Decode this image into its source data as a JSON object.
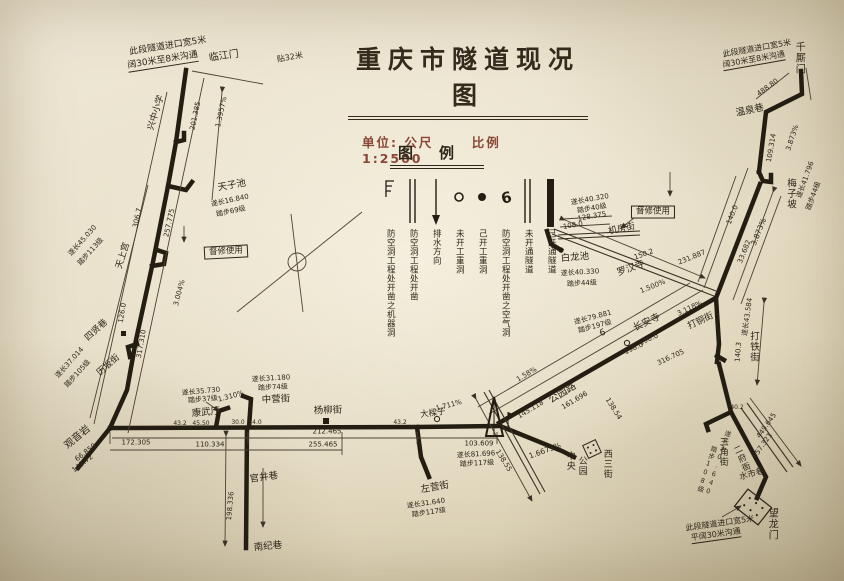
{
  "title": "重庆市隧道现况图",
  "subtitle": {
    "unit_label": "单位: 公尺",
    "scale_label": "比例 1:2500"
  },
  "colors": {
    "ink": "#2e2619",
    "thin_line": "#4c4234",
    "accent_red": "#8a4636",
    "paper": "#e9e1cb"
  },
  "legend": {
    "title": "图例",
    "entries": [
      {
        "symbol": "bracket-icon",
        "label": "防空洞工程处开凿之机器洞"
      },
      {
        "symbol": "double-line-icon",
        "label": "防空洞工程处开凿"
      },
      {
        "symbol": "arrow-down-icon",
        "label": "排水方向"
      },
      {
        "symbol": "open-circle-icon",
        "label": "未开工重洞"
      },
      {
        "symbol": "solid-dot-icon",
        "label": "己开工重洞"
      },
      {
        "symbol": "air-hole-icon",
        "label": "防空洞工程处开凿之空气洞"
      },
      {
        "symbol": "double-line-icon",
        "label": "未开通隧道"
      },
      {
        "symbol": "thick-bar-icon",
        "label": "己开通隧道"
      }
    ]
  },
  "map": {
    "labels": [
      {
        "t": "此段隧道进口宽5米",
        "x": 168,
        "y": 47,
        "r": -9,
        "s": 9
      },
      {
        "t": "阔30米至8米沟通",
        "x": 163,
        "y": 62,
        "r": -9,
        "s": 9,
        "u": 1
      },
      {
        "t": "贴32米",
        "x": 290,
        "y": 58,
        "r": -10,
        "s": 8
      },
      {
        "t": "临江门",
        "x": 224,
        "y": 57,
        "r": -8,
        "s": 10
      },
      {
        "t": "兴中小学",
        "x": 157,
        "y": 113,
        "r": -73,
        "s": 9
      },
      {
        "t": "1.3957%",
        "x": 222,
        "y": 112,
        "r": -78,
        "s": 7
      },
      {
        "t": "201.385",
        "x": 196,
        "y": 116,
        "r": -78,
        "s": 7
      },
      {
        "t": "天子池",
        "x": 232,
        "y": 186,
        "r": -10,
        "s": 9.5
      },
      {
        "t": "遂长16.840",
        "x": 230,
        "y": 201,
        "r": -12,
        "s": 7
      },
      {
        "t": "踏步69级",
        "x": 231,
        "y": 212,
        "r": -12,
        "s": 7
      },
      {
        "t": "督修使用",
        "x": 226,
        "y": 252,
        "r": -3,
        "s": 8.5,
        "b": 1
      },
      {
        "t": "306.7",
        "x": 138,
        "y": 218,
        "r": -78,
        "s": 7
      },
      {
        "t": "257.775",
        "x": 170,
        "y": 223,
        "r": -78,
        "s": 7
      },
      {
        "t": "天上宫",
        "x": 124,
        "y": 256,
        "r": -73,
        "s": 9
      },
      {
        "t": "遂长45.030",
        "x": 83,
        "y": 241,
        "r": -48,
        "s": 7
      },
      {
        "t": "踏步113级",
        "x": 91,
        "y": 252,
        "r": -48,
        "s": 7
      },
      {
        "t": "3.004%",
        "x": 180,
        "y": 293,
        "r": -75,
        "s": 7
      },
      {
        "t": "126.0",
        "x": 123,
        "y": 313,
        "r": -80,
        "s": 7
      },
      {
        "t": "317.310",
        "x": 142,
        "y": 344,
        "r": -80,
        "s": 7
      },
      {
        "t": "四贤巷",
        "x": 97,
        "y": 331,
        "r": -42,
        "s": 9
      },
      {
        "t": "历坂街",
        "x": 109,
        "y": 366,
        "r": -42,
        "s": 9
      },
      {
        "t": "遂长37.014",
        "x": 70,
        "y": 363,
        "r": -48,
        "s": 7
      },
      {
        "t": "踏步105级",
        "x": 78,
        "y": 374,
        "r": -48,
        "s": 7
      },
      {
        "t": "观音岩",
        "x": 78,
        "y": 438,
        "r": -40,
        "s": 10
      },
      {
        "t": "66.850",
        "x": 86,
        "y": 453,
        "r": -38,
        "s": 7
      },
      {
        "t": "149.72",
        "x": 83,
        "y": 464,
        "r": -38,
        "s": 7
      },
      {
        "t": "172.305",
        "x": 136,
        "y": 443,
        "r": 0,
        "s": 7
      },
      {
        "t": "110.334",
        "x": 210,
        "y": 445,
        "r": 0,
        "s": 7
      },
      {
        "t": "43.2",
        "x": 180,
        "y": 424,
        "r": 0,
        "s": 6
      },
      {
        "t": "45.50",
        "x": 201,
        "y": 424,
        "r": 0,
        "s": 6
      },
      {
        "t": "康武厅",
        "x": 206,
        "y": 413,
        "r": -5,
        "s": 9.5
      },
      {
        "t": "遂长35.730",
        "x": 201,
        "y": 392,
        "r": -5,
        "s": 7
      },
      {
        "t": "踏步37级",
        "x": 203,
        "y": 400,
        "r": -5,
        "s": 7
      },
      {
        "t": "1.310%",
        "x": 231,
        "y": 397,
        "r": -15,
        "s": 7
      },
      {
        "t": "中营街",
        "x": 276,
        "y": 400,
        "r": -3,
        "s": 9.5
      },
      {
        "t": "遂长31.180",
        "x": 271,
        "y": 379,
        "r": -3,
        "s": 7
      },
      {
        "t": "踏步74级",
        "x": 273,
        "y": 388,
        "r": -3,
        "s": 7
      },
      {
        "t": "30.0",
        "x": 238,
        "y": 423,
        "r": 0,
        "s": 6
      },
      {
        "t": "14.0",
        "x": 255,
        "y": 423,
        "r": 0,
        "s": 6
      },
      {
        "t": "杨柳街",
        "x": 328,
        "y": 411,
        "r": -2,
        "s": 9.5
      },
      {
        "t": "212.465",
        "x": 327,
        "y": 432,
        "r": 0,
        "s": 7
      },
      {
        "t": "255.465",
        "x": 323,
        "y": 445,
        "r": 0,
        "s": 7
      },
      {
        "t": "43.2",
        "x": 400,
        "y": 423,
        "r": 0,
        "s": 6
      },
      {
        "t": "官井巷",
        "x": 264,
        "y": 478,
        "r": -8,
        "s": 9.5
      },
      {
        "t": "198.336",
        "x": 231,
        "y": 506,
        "r": -85,
        "s": 7
      },
      {
        "t": "南纪巷",
        "x": 268,
        "y": 547,
        "r": -5,
        "s": 9.5
      },
      {
        "t": "大樑子",
        "x": 433,
        "y": 414,
        "r": -8,
        "s": 8.5
      },
      {
        "t": "103.609",
        "x": 479,
        "y": 444,
        "r": 0,
        "s": 7
      },
      {
        "t": "遂长81.696",
        "x": 476,
        "y": 455,
        "r": -3,
        "s": 7
      },
      {
        "t": "踏步117级",
        "x": 477,
        "y": 464,
        "r": -3,
        "s": 7
      },
      {
        "t": "左营街",
        "x": 435,
        "y": 488,
        "r": -10,
        "s": 9.5
      },
      {
        "t": "遂长31.640",
        "x": 426,
        "y": 504,
        "r": -8,
        "s": 7
      },
      {
        "t": "踏步117级",
        "x": 429,
        "y": 513,
        "r": -8,
        "s": 7
      },
      {
        "t": "1.711%",
        "x": 449,
        "y": 406,
        "r": -15,
        "s": 7
      },
      {
        "t": "公园路",
        "x": 563,
        "y": 394,
        "r": -31,
        "s": 10
      },
      {
        "t": "145.118",
        "x": 531,
        "y": 410,
        "r": -31,
        "s": 7
      },
      {
        "t": "161.696",
        "x": 575,
        "y": 401,
        "r": -31,
        "s": 7
      },
      {
        "t": "1.58%",
        "x": 527,
        "y": 375,
        "r": -31,
        "s": 7
      },
      {
        "t": "1.6673%",
        "x": 545,
        "y": 451,
        "r": -20,
        "s": 7.5
      },
      {
        "t": "138.55",
        "x": 503,
        "y": 461,
        "r": 58,
        "s": 7
      },
      {
        "t": "138.54",
        "x": 613,
        "y": 409,
        "r": 58,
        "s": 7
      },
      {
        "t": "中央",
        "x": 569,
        "y": 461,
        "v": 1,
        "s": 9
      },
      {
        "t": "公园",
        "x": 581,
        "y": 466,
        "v": 1,
        "s": 9
      },
      {
        "t": "西三街",
        "x": 606,
        "y": 464,
        "v": 1,
        "s": 9
      },
      {
        "t": "督修使用",
        "x": 653,
        "y": 212,
        "r": 0,
        "s": 8.5,
        "b": 1
      },
      {
        "t": "机房街",
        "x": 622,
        "y": 230,
        "r": -12,
        "s": 9
      },
      {
        "t": "遂长40.320",
        "x": 590,
        "y": 200,
        "r": -10,
        "s": 7
      },
      {
        "t": "踏步40级",
        "x": 592,
        "y": 209,
        "r": -10,
        "s": 7
      },
      {
        "t": "128.375",
        "x": 592,
        "y": 217,
        "r": -10,
        "s": 7
      },
      {
        "t": "108.0",
        "x": 573,
        "y": 226,
        "r": -10,
        "s": 7
      },
      {
        "t": "白龙池",
        "x": 575,
        "y": 258,
        "r": -5,
        "s": 9.5
      },
      {
        "t": "遂长40.330",
        "x": 580,
        "y": 273,
        "r": -3,
        "s": 7
      },
      {
        "t": "踏步44级",
        "x": 582,
        "y": 284,
        "r": -3,
        "s": 7
      },
      {
        "t": "罗汉寺",
        "x": 631,
        "y": 269,
        "r": -20,
        "s": 9.5
      },
      {
        "t": "150.2",
        "x": 644,
        "y": 255,
        "r": -20,
        "s": 7
      },
      {
        "t": "231.887",
        "x": 692,
        "y": 258,
        "r": -22,
        "s": 7
      },
      {
        "t": "1.500%",
        "x": 653,
        "y": 287,
        "r": -22,
        "s": 7
      },
      {
        "t": "3.118%",
        "x": 690,
        "y": 309,
        "r": -25,
        "s": 7
      },
      {
        "t": "长安寺",
        "x": 647,
        "y": 323,
        "r": -25,
        "s": 9.5
      },
      {
        "t": "打铜街",
        "x": 701,
        "y": 322,
        "r": -25,
        "s": 9
      },
      {
        "t": "198.0",
        "x": 634,
        "y": 349,
        "r": -25,
        "s": 7
      },
      {
        "t": "316.705",
        "x": 671,
        "y": 358,
        "r": -25,
        "s": 7
      },
      {
        "t": "190.0",
        "x": 649,
        "y": 340,
        "r": -25,
        "s": 7
      },
      {
        "t": "遂长79.881",
        "x": 593,
        "y": 318,
        "r": -15,
        "s": 7
      },
      {
        "t": "踏步197级",
        "x": 595,
        "y": 327,
        "r": -15,
        "s": 7
      },
      {
        "t": "6",
        "x": 603,
        "y": 334,
        "r": -20,
        "s": 9
      },
      {
        "t": "此段隧道进口宽5米",
        "x": 757,
        "y": 49,
        "r": -10,
        "s": 8
      },
      {
        "t": "阔30米至8米沟通",
        "x": 754,
        "y": 61,
        "r": -10,
        "s": 8,
        "u": 1
      },
      {
        "t": "千厮门",
        "x": 798,
        "y": 58,
        "v": 1,
        "s": 10
      },
      {
        "t": "488.80",
        "x": 768,
        "y": 88,
        "r": -36,
        "s": 7
      },
      {
        "t": "温泉巷",
        "x": 750,
        "y": 111,
        "r": -12,
        "s": 9.5
      },
      {
        "t": "109.314",
        "x": 772,
        "y": 148,
        "r": -80,
        "s": 7
      },
      {
        "t": "3.873%",
        "x": 793,
        "y": 138,
        "r": -72,
        "s": 7
      },
      {
        "t": "梅子坡",
        "x": 790,
        "y": 194,
        "v": 1,
        "s": 9.5
      },
      {
        "t": "遂长41.796",
        "x": 806,
        "y": 180,
        "r": -70,
        "s": 7
      },
      {
        "t": "踏步44级",
        "x": 814,
        "y": 196,
        "r": -70,
        "s": 7
      },
      {
        "t": "140.0",
        "x": 733,
        "y": 215,
        "r": -68,
        "s": 7
      },
      {
        "t": "3.873%",
        "x": 759,
        "y": 232,
        "r": -68,
        "s": 7.5
      },
      {
        "t": "33.682",
        "x": 745,
        "y": 252,
        "r": -68,
        "s": 7
      },
      {
        "t": "遂长43.584",
        "x": 748,
        "y": 317,
        "r": -82,
        "s": 7
      },
      {
        "t": "打铁街",
        "x": 753,
        "y": 347,
        "v": 1,
        "s": 9.5
      },
      {
        "t": "140.3",
        "x": 739,
        "y": 352,
        "r": -85,
        "s": 7
      },
      {
        "t": "40.2",
        "x": 737,
        "y": 408,
        "r": 0,
        "s": 6
      },
      {
        "t": "三角街",
        "x": 722,
        "y": 452,
        "v": 1,
        "s": 9
      },
      {
        "t": "二府衙",
        "x": 741,
        "y": 459,
        "v": 1,
        "r": -25,
        "s": 8.5
      },
      {
        "t": "水市巷",
        "x": 752,
        "y": 475,
        "r": -15,
        "s": 8.5
      },
      {
        "t": "遂长30.640",
        "x": 717,
        "y": 463,
        "v": 1,
        "r": 18,
        "s": 6.5
      },
      {
        "t": "踏步108级",
        "x": 706,
        "y": 469,
        "v": 1,
        "r": 18,
        "s": 6.5
      },
      {
        "t": "望龙门",
        "x": 771,
        "y": 524,
        "v": 1,
        "s": 10
      },
      {
        "t": "此段隧道进口宽5米",
        "x": 720,
        "y": 524,
        "r": -8,
        "s": 8
      },
      {
        "t": "平阔30米沟通",
        "x": 716,
        "y": 536,
        "r": -8,
        "s": 8,
        "u": 1
      },
      {
        "t": "449.645",
        "x": 767,
        "y": 426,
        "r": -55,
        "s": 7
      },
      {
        "t": "457.321",
        "x": 763,
        "y": 446,
        "r": -55,
        "s": 7
      }
    ]
  }
}
